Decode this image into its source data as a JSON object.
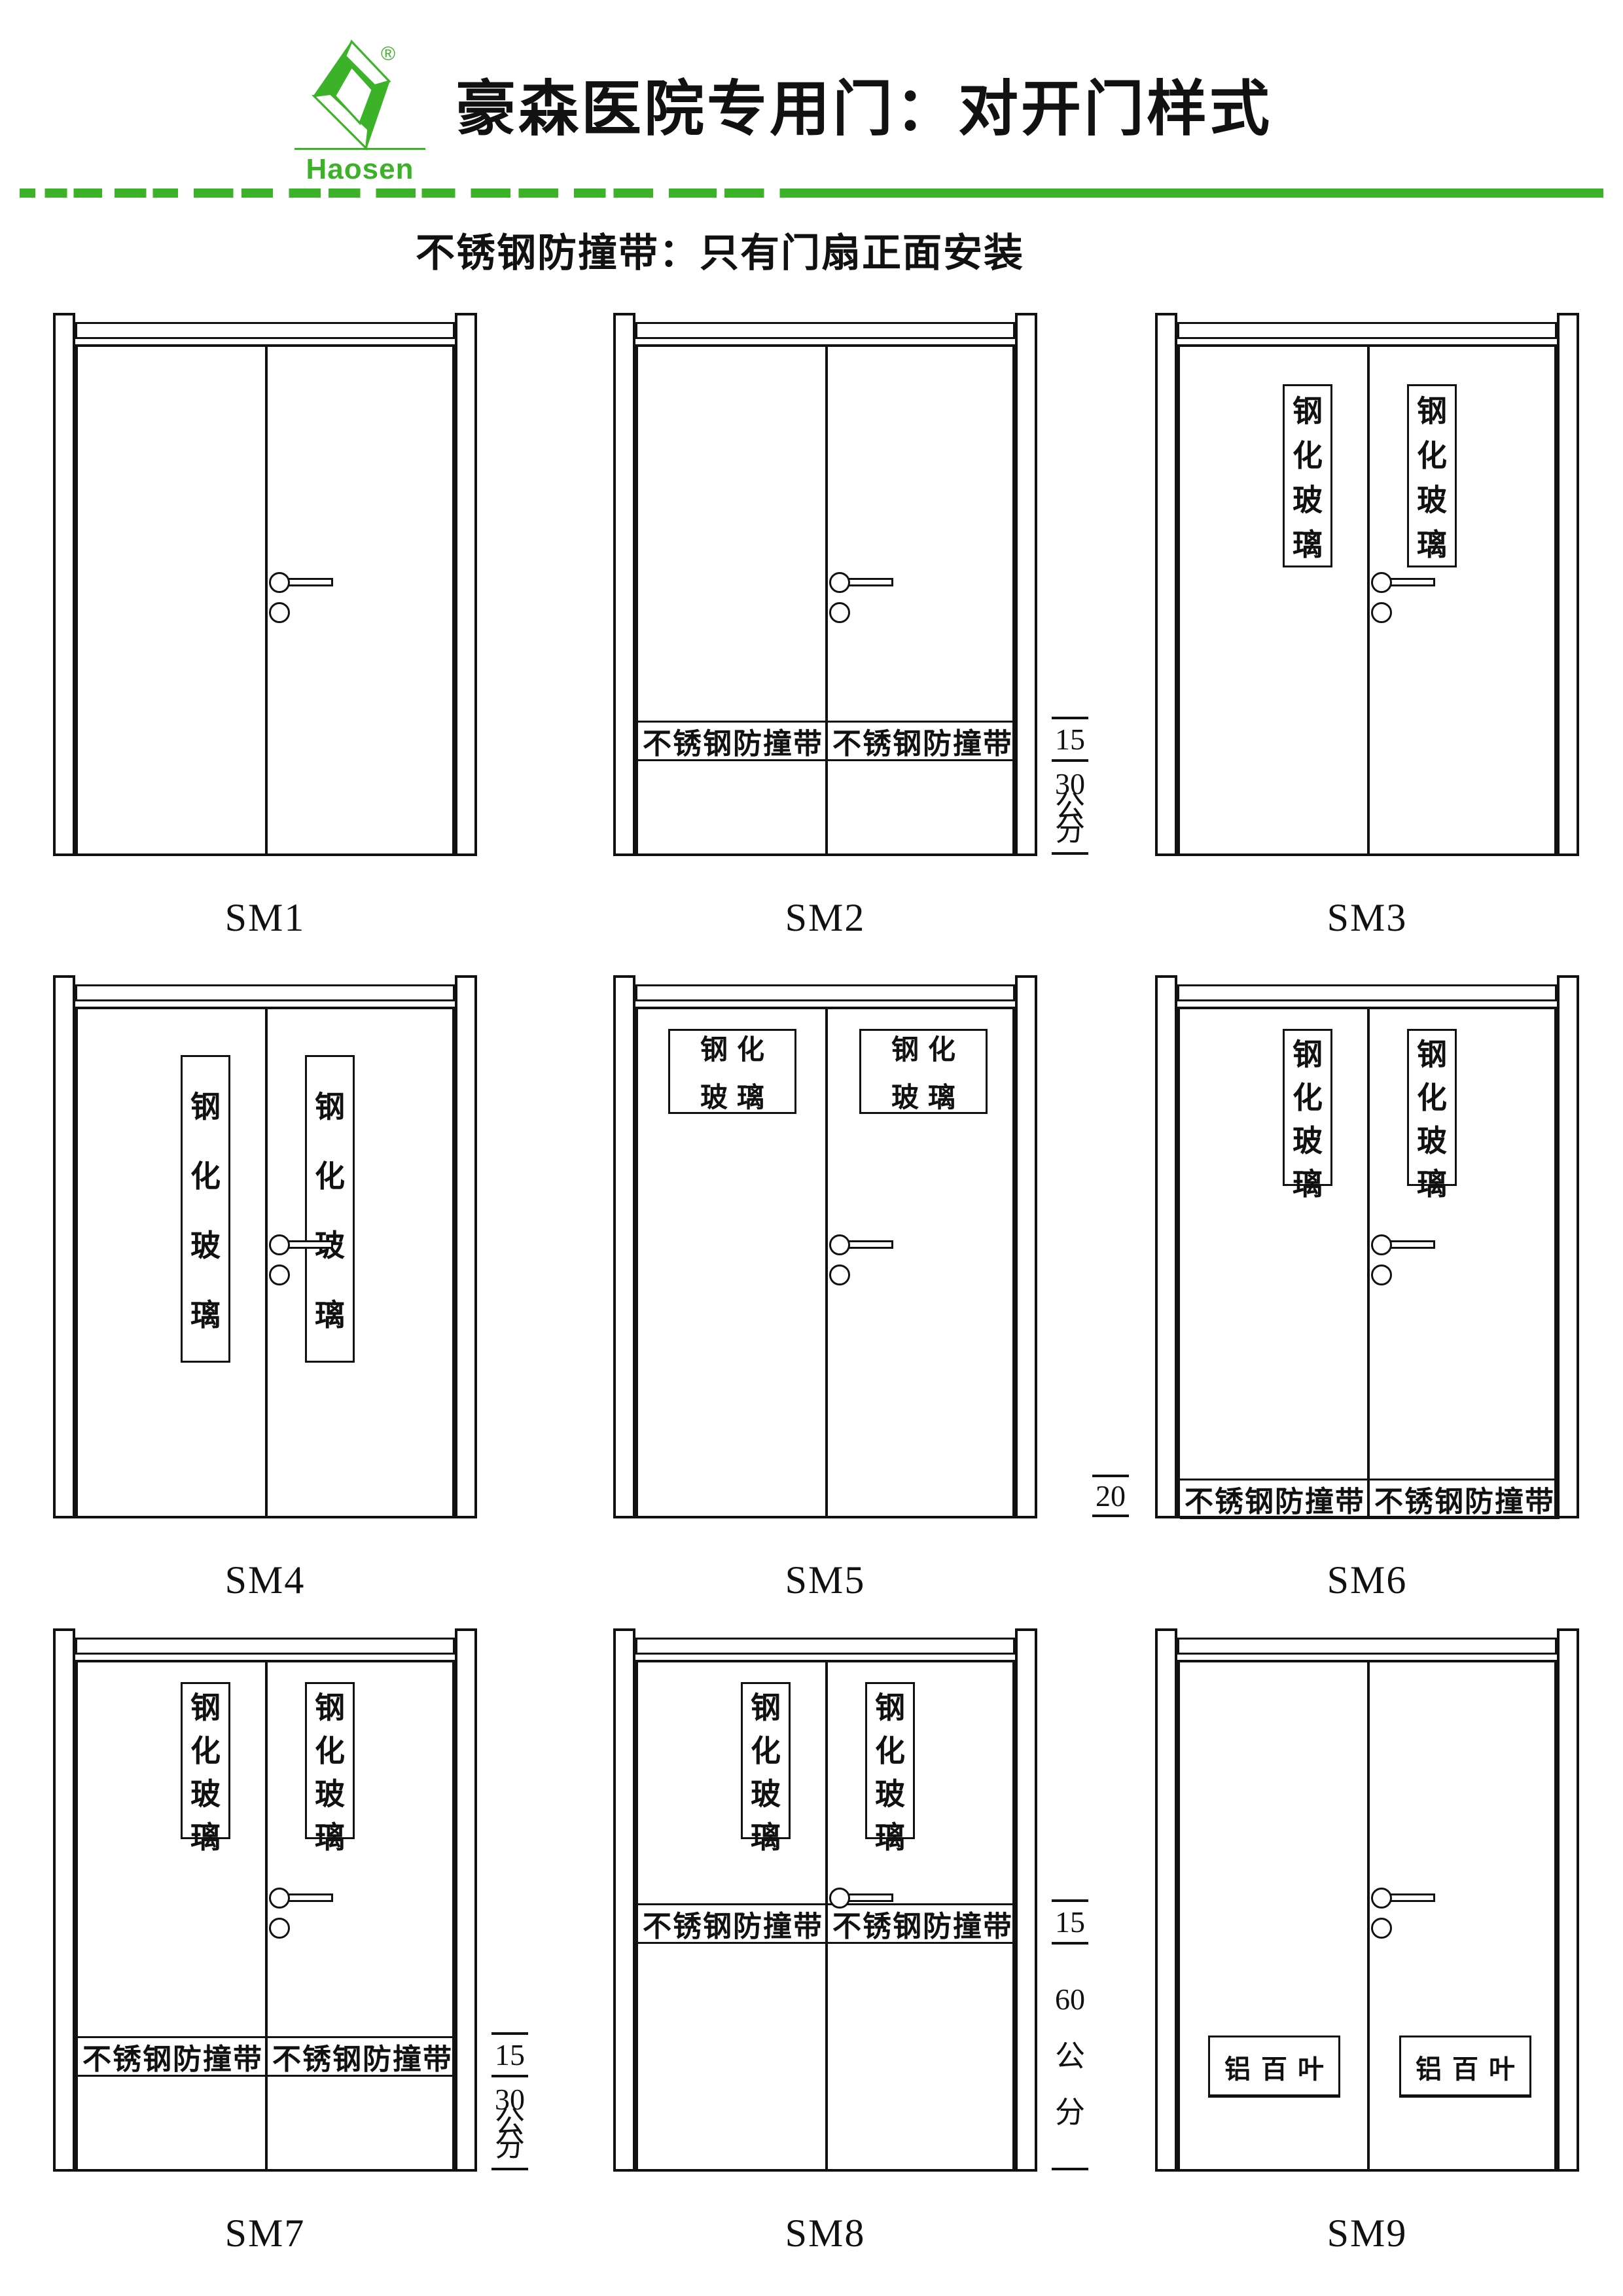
{
  "logo": {
    "brand": "Haosen",
    "registered": "®",
    "color": "#3cb228"
  },
  "header": {
    "title": "豪森医院专用门：对开门样式",
    "subtitle": "不锈钢防撞带：只有门扇正面安装"
  },
  "colors": {
    "accent_green": "#3cb228",
    "line_black": "#111111"
  },
  "texts": {
    "tempered_glass_vertical": "钢化玻璃",
    "tempered_glass_lines": [
      "钢化",
      "玻璃"
    ],
    "bumper_band": "不锈钢防撞带",
    "louver": "铝百叶"
  },
  "doors": [
    {
      "label": "SM1",
      "glass": null,
      "band": null,
      "dims": null,
      "handle": {
        "cylinder": true
      }
    },
    {
      "label": "SM2",
      "glass": null,
      "band": "low",
      "dims": {
        "side": "right",
        "first": "15",
        "rest": [
          "30",
          "公",
          "分"
        ]
      },
      "handle": {
        "cylinder": true
      }
    },
    {
      "label": "SM3",
      "glass": "tall-upper",
      "band": null,
      "dims": null,
      "handle": {
        "cylinder": true
      }
    },
    {
      "label": "SM4",
      "glass": "tall-long",
      "band": null,
      "dims": null,
      "handle": {
        "cylinder": true
      }
    },
    {
      "label": "SM5",
      "glass": "box",
      "band": null,
      "dims": null,
      "handle": {
        "cylinder": true
      }
    },
    {
      "label": "SM6",
      "glass": "narrow-upper",
      "band": "bottom",
      "dims": {
        "side": "left",
        "first": "20",
        "rest": []
      },
      "handle": {
        "cylinder": true
      }
    },
    {
      "label": "SM7",
      "glass": "narrow-upper",
      "band": "low",
      "dims": {
        "side": "right",
        "first": "15",
        "rest": [
          "30",
          "公",
          "分"
        ]
      },
      "handle": {
        "cylinder": true
      }
    },
    {
      "label": "SM8",
      "glass": "narrow-upper",
      "band": "middle",
      "dims": {
        "side": "right",
        "first": "15",
        "rest": [
          "60",
          "公",
          "分"
        ]
      },
      "handle": {
        "cylinder": false
      }
    },
    {
      "label": "SM9",
      "glass": "louver",
      "band": null,
      "dims": null,
      "handle": {
        "cylinder": true
      }
    }
  ]
}
